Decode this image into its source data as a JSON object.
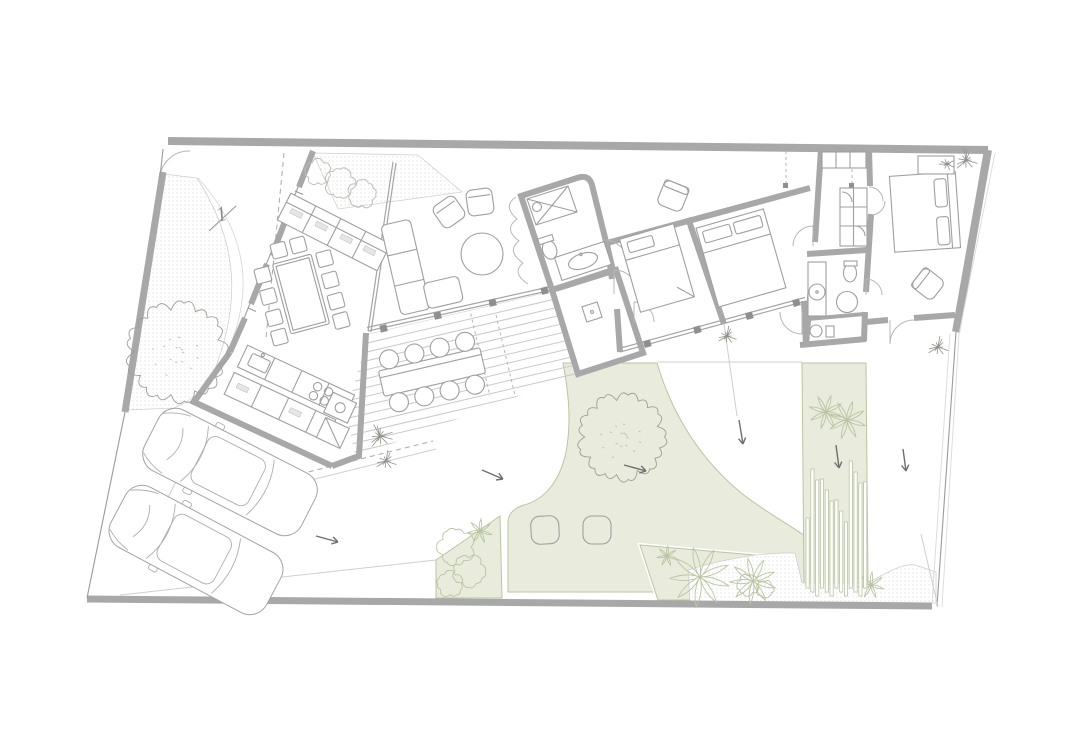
{
  "document": {
    "parcel_label": "1"
  },
  "colors": {
    "wall": "#a8a8a8",
    "line": "#9a9a9a",
    "furn": "#9f9f9f",
    "ground": "#cfcfcf",
    "gfill": "#e9ecdd",
    "gstroke": "#b9c5a2",
    "dot": "#c9c9c9",
    "arrow": "#6f6f6f",
    "paper": "#ffffff"
  }
}
